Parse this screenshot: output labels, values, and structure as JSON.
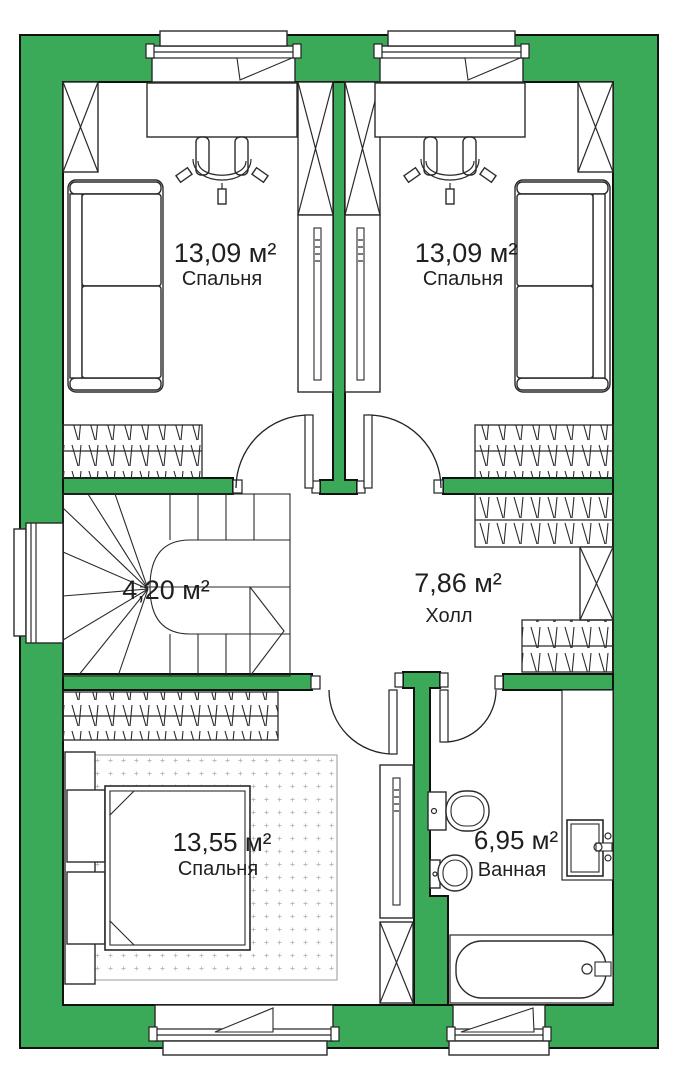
{
  "plan": {
    "rooms": [
      {
        "id": "bedroom-top-left",
        "area": "13,09 м²",
        "name": "Спальня"
      },
      {
        "id": "bedroom-top-right",
        "area": "13,09 м²",
        "name": "Спальня"
      },
      {
        "id": "stairs",
        "area": "4,20 м²",
        "name": ""
      },
      {
        "id": "hall",
        "area": "7,86 м²",
        "name": "Холл"
      },
      {
        "id": "bedroom-bottom",
        "area": "13,55 м²",
        "name": "Спальня"
      },
      {
        "id": "bathroom",
        "area": "6,95 м²",
        "name": "Ванная"
      }
    ],
    "colors": {
      "wall": "#3aaa58",
      "floor": "#ffffff",
      "line": "#1a1a1a",
      "text": "#1f1f1f"
    }
  }
}
